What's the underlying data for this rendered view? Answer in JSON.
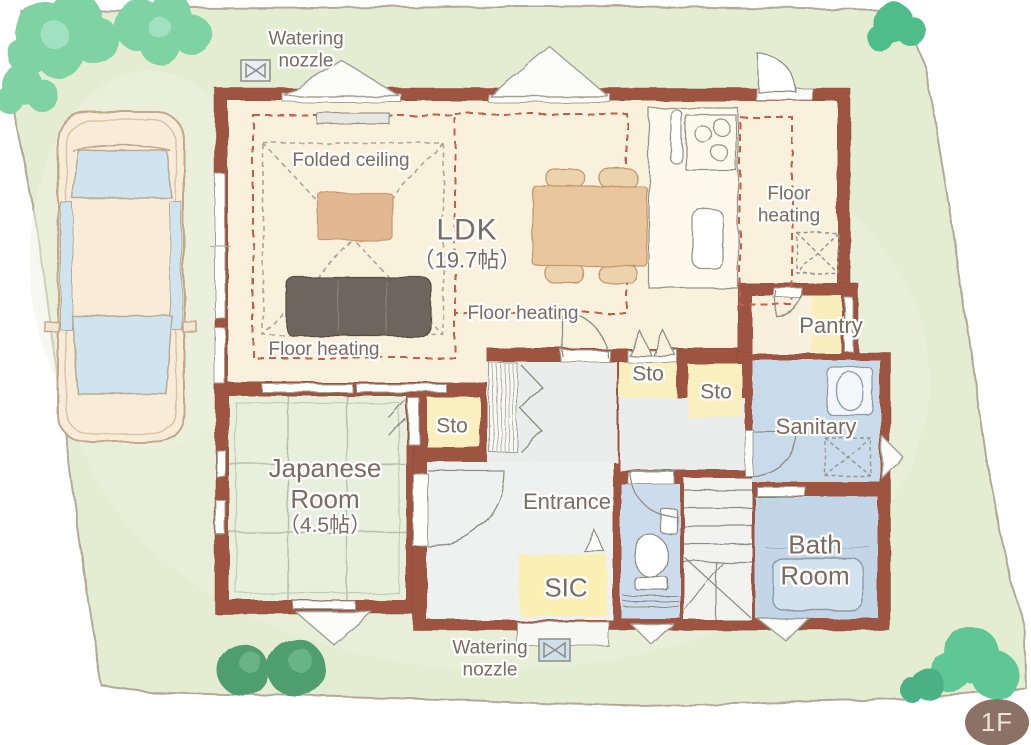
{
  "floor_badge": "1F",
  "rooms": {
    "ldk": {
      "name": "LDK",
      "size": "（19.7帖）"
    },
    "japanese_room": {
      "name_line1": "Japanese",
      "name_line2": "Room",
      "size": "（4.5帖）"
    },
    "entrance": {
      "name": "Entrance"
    },
    "sic": {
      "name": "SIC"
    },
    "bath_room": {
      "name_line1": "Bath",
      "name_line2": "Room"
    },
    "sanitary": {
      "name": "Sanitary"
    },
    "pantry": {
      "name": "Pantry"
    },
    "storage": {
      "name": "Sto"
    }
  },
  "annotations": {
    "folded_ceiling": "Folded ceiling",
    "floor_heating": "Floor heating",
    "floor_heating_line1": "Floor",
    "floor_heating_line2": "heating",
    "watering_nozzle_line1": "Watering",
    "watering_nozzle_line2": "nozzle"
  },
  "icons": {
    "watering_nozzle_icon": "⋈"
  },
  "colors": {
    "lawn": "#e4ecd2",
    "wall": "#9d5542",
    "ldk_floor": "#faf1dd",
    "tatami": "#e8efdc",
    "hall": "#ebedec",
    "wet_room_blue": "#c9dbea",
    "storage_yellow": "#faf0bf",
    "floor_heating_dash": "#c4604a",
    "label_text": "#7b6b60",
    "badge": "#8c7166",
    "tree_light": "#7ed2a4",
    "tree_dark": "#4f9e70"
  }
}
